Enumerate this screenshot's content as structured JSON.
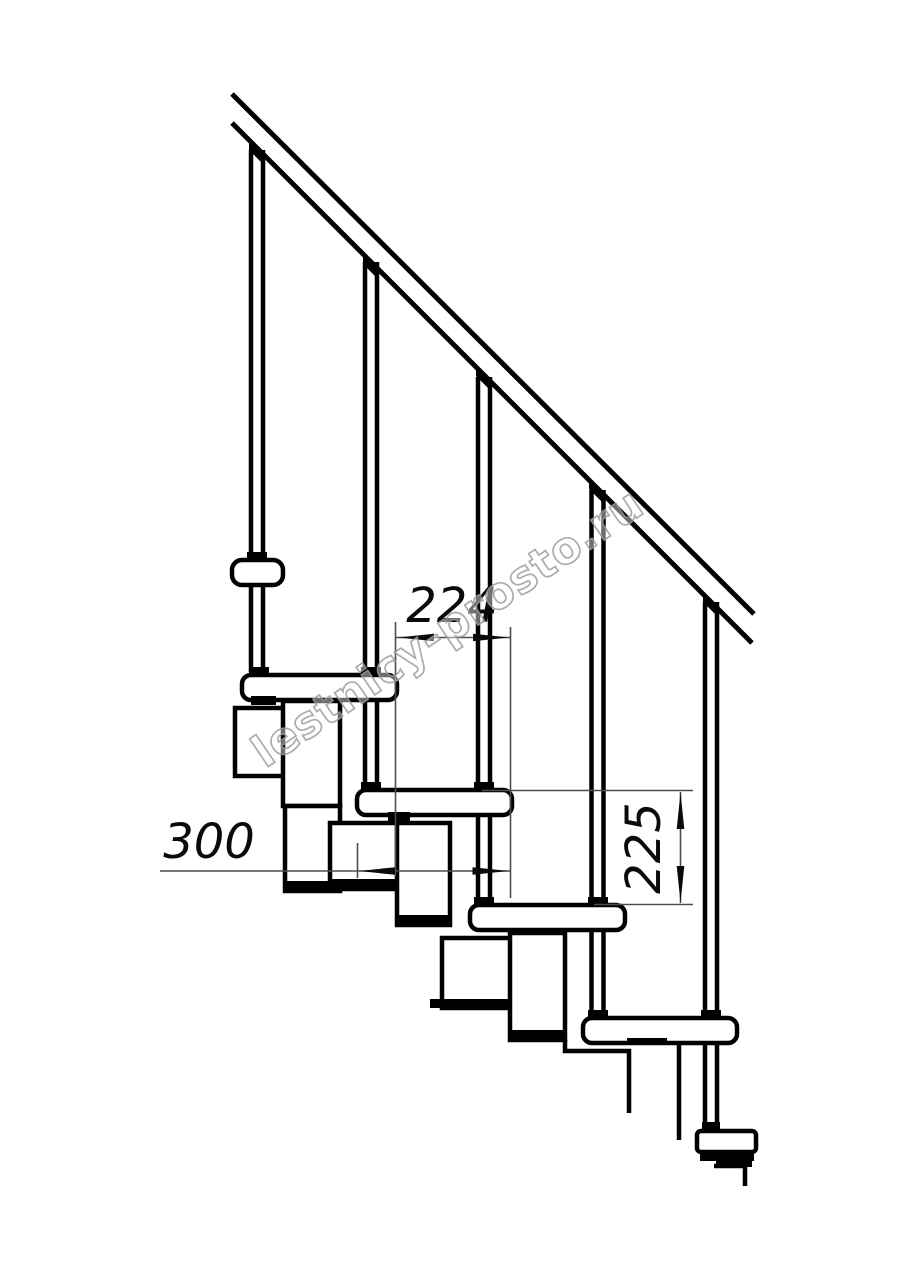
{
  "document": {
    "kind": "technical line drawing - side elevation of modular staircase with handrail",
    "background_color": "#ffffff",
    "line_color": "#000000",
    "dimension_line_color": "#4d4d4d"
  },
  "watermark": {
    "text": "lestnicy-prosto.ru",
    "outline_color": "#9e9e9e"
  },
  "dimensions": {
    "step_run": {
      "value": "224",
      "orientation": "horizontal"
    },
    "tread_depth": {
      "value": "300",
      "orientation": "horizontal"
    },
    "step_rise": {
      "value": "225",
      "orientation": "vertical"
    }
  },
  "structure": {
    "balusters": 5,
    "treads": 5,
    "handrail_lines": 2
  }
}
